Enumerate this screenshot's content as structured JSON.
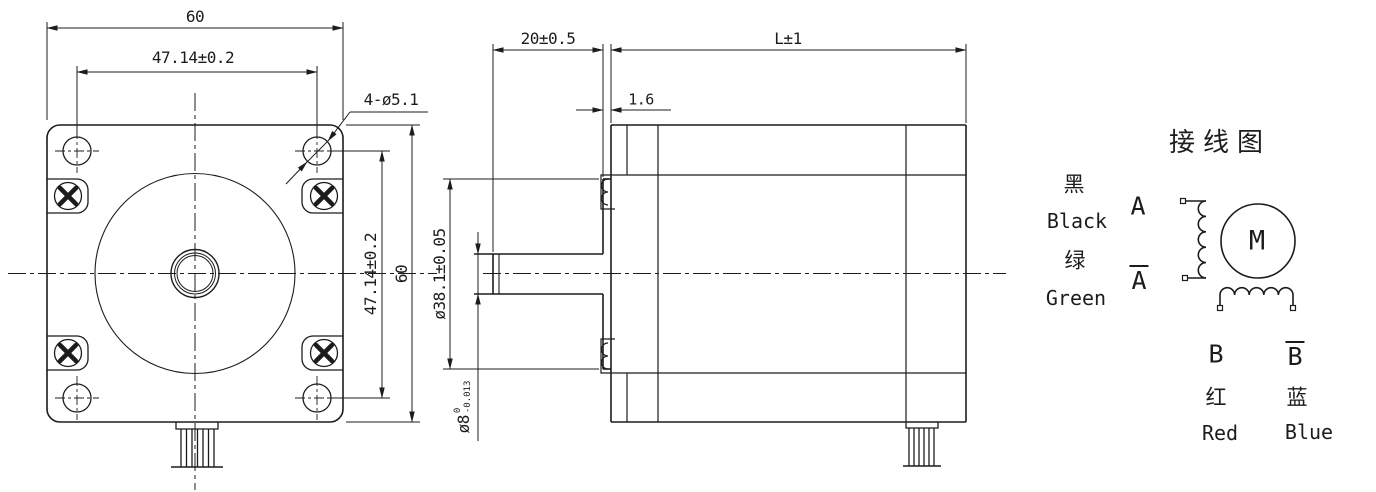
{
  "meta": {
    "background": "#ffffff",
    "line_color": "#1c1c1c"
  },
  "front_view": {
    "dims": {
      "width_top": "60",
      "bolt_spacing_top": "47.14±0.2",
      "mount_holes": "4-ø5.1",
      "bolt_spacing_right": "47.14±0.2",
      "height_right": "60"
    }
  },
  "side_view": {
    "dims": {
      "shaft_length": "20±0.5",
      "body_length": "L±1",
      "pilot_depth": "1.6",
      "pilot_diameter": "ø38.1±0.05",
      "shaft_diameter": "ø8",
      "shaft_tol_upper": "0",
      "shaft_tol_lower": "-0.013"
    }
  },
  "wiring_diagram": {
    "title": "接线图",
    "motor_label": "M",
    "leads": [
      {
        "wire_cn": "黑",
        "wire_en": "Black",
        "phase": "A"
      },
      {
        "wire_cn": "绿",
        "wire_en": "Green",
        "phase": "A"
      },
      {
        "wire_cn": "红",
        "wire_en": "Red",
        "phase": "B"
      },
      {
        "wire_cn": "蓝",
        "wire_en": "Blue",
        "phase": "B"
      }
    ]
  }
}
